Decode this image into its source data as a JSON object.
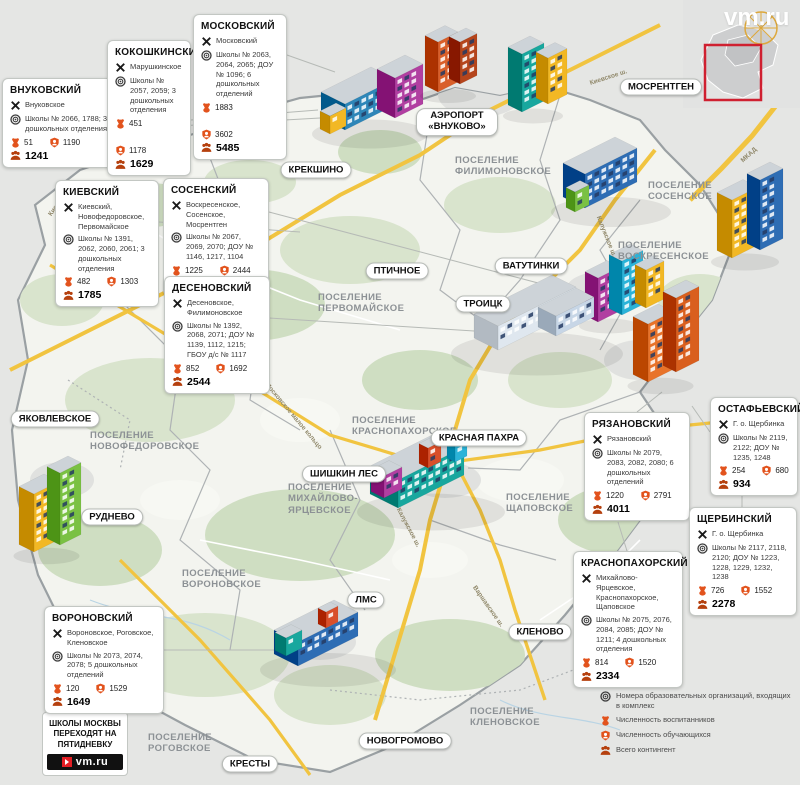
{
  "watermark": "vm.ru",
  "promo": {
    "text": "Школы Москвы переходят на пятидневку",
    "logo": "vm.ru"
  },
  "legend": {
    "items": [
      {
        "icon": "settlements-crossing-icon",
        "label": "Поселения"
      },
      {
        "icon": "org-numbers-icon",
        "label": "Номера образовательных организаций, входящих в комплекс"
      },
      {
        "icon": "kindergarten-bear-icon",
        "label": "Численность воспитанников"
      },
      {
        "icon": "student-badge-icon",
        "label": "Численность обучающихся"
      },
      {
        "icon": "total-group-icon",
        "label": "Всего контингент"
      }
    ]
  },
  "cards": [
    {
      "id": "vnukovsky",
      "title": "ВНУКОВСКИЙ",
      "settlements": "Внуковское",
      "schools": "Школы № 2066, 1788; 3 дошкольных отделения",
      "pupils": "51",
      "students": "1190",
      "total": "1241"
    },
    {
      "id": "kokoshkinsky",
      "title": "КОКОШКИНСКИЙ",
      "settlements": "Марушкинское",
      "schools": "Школы № 2057, 2059; 3 дошкольных отделения",
      "pupils": "451",
      "students": "1178",
      "total": "1629"
    },
    {
      "id": "moskovsky",
      "title": "МОСКОВСКИЙ",
      "settlements": "Московский",
      "schools": "Школы № 2063, 2064, 2065; ДОУ № 1096; 6 дошкольных отделений",
      "pupils": "1883",
      "students": "3602",
      "total": "5485"
    },
    {
      "id": "kievsky",
      "title": "КИЕВСКИЙ",
      "settlements": "Киевский, Новофедоровское, Первомайское",
      "schools": "Школы № 1391, 2062, 2060, 2061; 3 дошкольных отделения",
      "pupils": "482",
      "students": "1303",
      "total": "1785"
    },
    {
      "id": "sosensky",
      "title": "СОСЕНСКИЙ",
      "settlements": "Воскресенское, Сосенское, Мосрентген",
      "schools": "Школы № 2067, 2069, 2070; ДОУ № 1146, 1217, 1104",
      "pupils": "1225",
      "students": "2444",
      "total": "3669"
    },
    {
      "id": "desenovsky",
      "title": "ДЕСЕНОВСКИЙ",
      "settlements": "Десеновское, Филимоновское",
      "schools": "Школы № 1392, 2068, 2071; ДОУ № 1139, 1112, 1215; ГБОУ д/с № 1117",
      "pupils": "852",
      "students": "1692",
      "total": "2544"
    },
    {
      "id": "ryazanovsky",
      "title": "РЯЗАНОВСКИЙ",
      "settlements": "Рязановский",
      "schools": "Школы № 2079, 2083, 2082, 2080; 6 дошкольных отделений",
      "pupils": "1220",
      "students": "2791",
      "total": "4011"
    },
    {
      "id": "ostafyevsky",
      "title": "ОСТАФЬЕВСКИЙ",
      "settlements": "Г. о. Щербинка",
      "schools": "Школы № 2119, 2122; ДОУ № 1235, 1248",
      "pupils": "254",
      "students": "680",
      "total": "934"
    },
    {
      "id": "shcherbinsky",
      "title": "ЩЕРБИНСКИЙ",
      "settlements": "Г. о. Щербинка",
      "schools": "Школы № 2117, 2118, 2120; ДОУ № 1223, 1228, 1229, 1232, 1238",
      "pupils": "726",
      "students": "1552",
      "total": "2278"
    },
    {
      "id": "krasnopakhorsky",
      "title": "КРАСНОПАХОРСКИЙ",
      "settlements": "Михайлово-Ярцевское, Краснопахорское, Щаповское",
      "schools": "Школы № 2075, 2076, 2084, 2085; ДОУ № 1211; 4 дошкольных отделения",
      "pupils": "814",
      "students": "1520",
      "total": "2334"
    },
    {
      "id": "voronovsky",
      "title": "ВОРОНОВСКИЙ",
      "settlements": "Вороновское, Роговское, Кленовское",
      "schools": "Школы № 2073, 2074, 2078; 5 дошкольных отделений",
      "pupils": "120",
      "students": "1529",
      "total": "1649"
    }
  ],
  "map": {
    "place_labels": [
      {
        "id": "krekshino",
        "text": "КРЕКШИНО"
      },
      {
        "id": "airport",
        "text": "АЭРОПОРТ «ВНУКОВО»"
      },
      {
        "id": "mosrentgen",
        "text": "МОСРЕНТГЕН"
      },
      {
        "id": "ptichnoye",
        "text": "ПТИЧНОЕ"
      },
      {
        "id": "vatutinki",
        "text": "ВАТУТИНКИ"
      },
      {
        "id": "troitsk",
        "text": "ТРОИЦК"
      },
      {
        "id": "krasnaya-pakhra",
        "text": "КРАСНАЯ ПАХРА"
      },
      {
        "id": "shishkin-les",
        "text": "ШИШКИН ЛЕС"
      },
      {
        "id": "yakovlevskoye",
        "text": "ЯКОВЛЕВСКОЕ"
      },
      {
        "id": "rudnevo",
        "text": "РУДНЕВО"
      },
      {
        "id": "lms",
        "text": "ЛМС"
      },
      {
        "id": "klenovo",
        "text": "КЛЕНОВО"
      },
      {
        "id": "novogromovo",
        "text": "НОВОГРОМОВО"
      },
      {
        "id": "kresty",
        "text": "КРЕСТЫ"
      }
    ],
    "region_labels": [
      {
        "id": "filimonovskoye",
        "text": "ПОСЕЛЕНИЕ ФИЛИМОНОВСКОЕ"
      },
      {
        "id": "sosenskoye",
        "text": "ПОСЕЛЕНИЕ СОСЕНСКОЕ"
      },
      {
        "id": "voskresenskoye",
        "text": "ПОСЕЛЕНИЕ ВОСКРЕСЕНСКОЕ"
      },
      {
        "id": "pervomayskoye",
        "text": "ПОСЕЛЕНИЕ ПЕРВОМАЙСКОЕ"
      },
      {
        "id": "krasnopakhorskoye",
        "text": "ПОСЕЛЕНИЕ КРАСНОПАХОРСКОЕ"
      },
      {
        "id": "mikhaylovo-yartsevskoye",
        "text": "ПОСЕЛЕНИЕ МИХАЙЛОВО-ЯРЦЕВСКОЕ"
      },
      {
        "id": "shchapovskoye",
        "text": "ПОСЕЛЕНИЕ ЩАПОВСКОЕ"
      },
      {
        "id": "novofedorovskoye",
        "text": "ПОСЕЛЕНИЕ НОВОФЕДОРОВСКОЕ"
      },
      {
        "id": "voronovskoye",
        "text": "ПОСЕЛЕНИЕ ВОРОНОВСКОЕ"
      },
      {
        "id": "klenovskoye",
        "text": "ПОСЕЛЕНИЕ КЛЕНОВСКОЕ"
      },
      {
        "id": "rogovskoye",
        "text": "ПОСЕЛЕНИЕ РОГОВСКОЕ"
      }
    ],
    "road_labels": [
      {
        "id": "kievskoye-nw",
        "text": "Киевское ш."
      },
      {
        "id": "kievskoye-ne",
        "text": "Киевское ш."
      },
      {
        "id": "kaluzhskoye-n",
        "text": "Калужское ш."
      },
      {
        "id": "kaluzhskoye-s",
        "text": "Калужское ш."
      },
      {
        "id": "varshavskoye",
        "text": "Варшавское ш."
      },
      {
        "id": "mkad",
        "text": "МКАД"
      },
      {
        "id": "mmk",
        "text": "Московское малое кольцо"
      }
    ]
  },
  "colors": {
    "accent_orange": "#e2531d",
    "group_orange_dark": "#b5400e",
    "road_yellow": "#f1c440",
    "boundary_gray": "#9aa0a3",
    "inset_red": "#cf2030",
    "logo_red": "#e31e24"
  }
}
